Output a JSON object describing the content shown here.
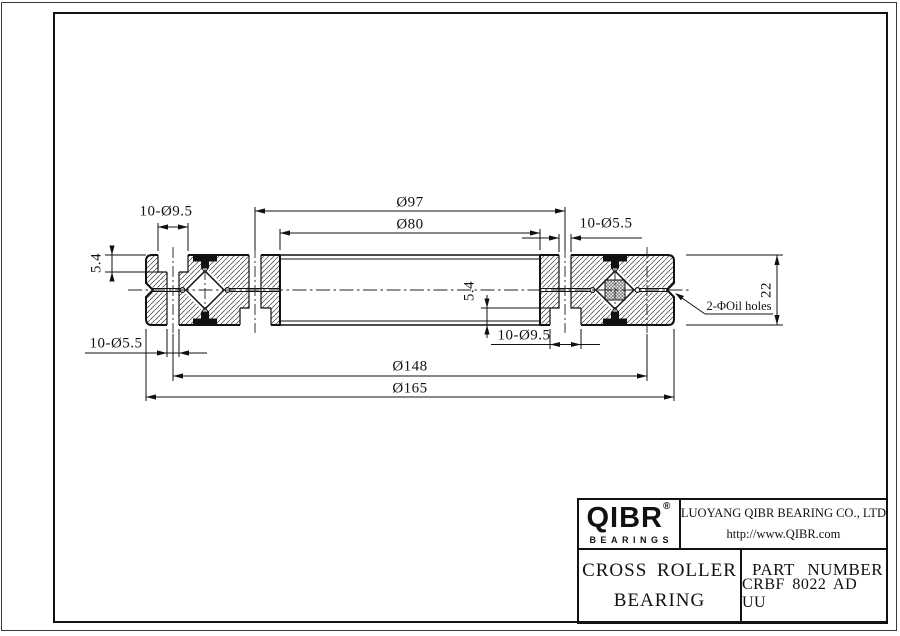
{
  "drawing": {
    "dims": {
      "bolt_circle_inner": "Ø97",
      "bore": "Ø80",
      "counterbore_top_left": "10-Ø9.5",
      "through_top_right": "10-Ø5.5",
      "through_bottom_left": "10-Ø5.5",
      "counterbore_bottom_mid": "10-Ø9.5",
      "bolt_circle_outer": "Ø148",
      "outer_diameter": "Ø165",
      "ring_width": "22",
      "counterbore_depth_left": "5.4",
      "counterbore_depth_mid": "5.4",
      "oil_holes_note": "2-ΦOil holes"
    }
  },
  "title_block": {
    "logo_text": "QIBR",
    "logo_registered": "®",
    "logo_subtitle": "BEARINGS",
    "company": "LUOYANG QIBR BEARING CO., LTD",
    "website": "http://www.QIBR.com",
    "product_line1": "CROSS ROLLER",
    "product_line2": "BEARING",
    "part_number_label": "PART NUMBER",
    "part_number": "CRBF 8022 AD UU"
  }
}
